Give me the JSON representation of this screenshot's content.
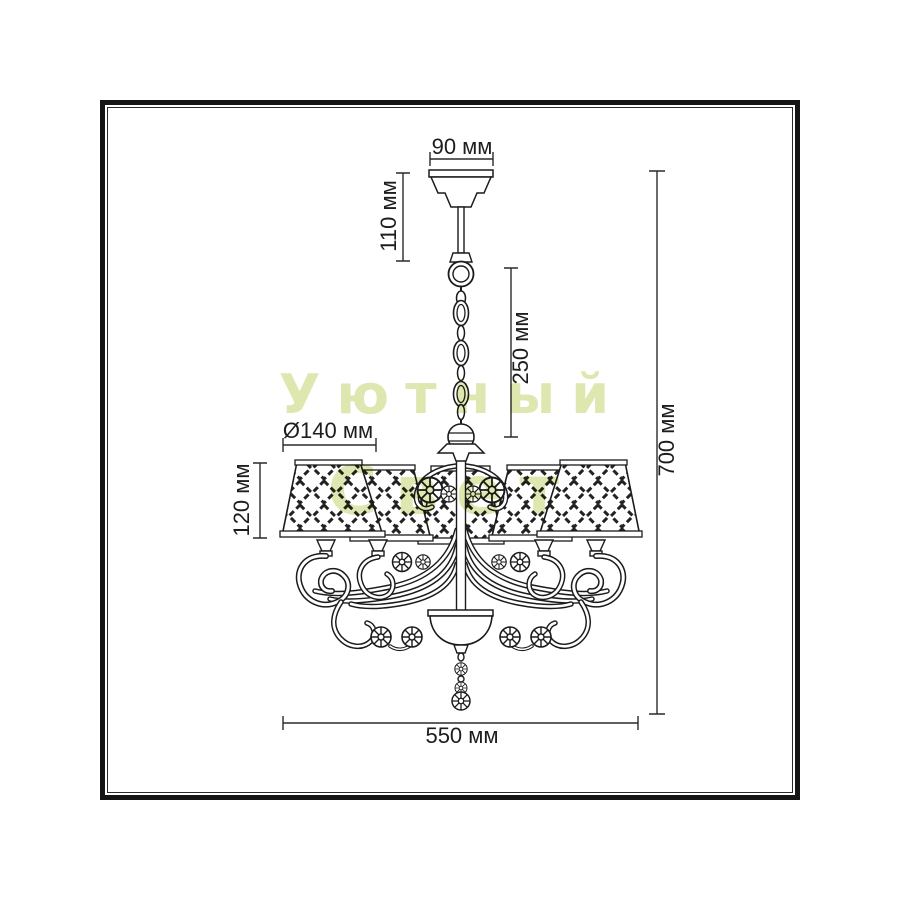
{
  "drawing": {
    "subject": "Chandelier dimensional technical drawing",
    "lampshade_count": 5,
    "line_color": "#1b1b1b",
    "background": "#ffffff",
    "frame_color": "#151515"
  },
  "dims": {
    "canopy_width": "90 мм",
    "top_drop": "110 мм",
    "chain_drop": "250 мм",
    "total_height": "700 мм",
    "shade_diameter": "Ø140 мм",
    "shade_height": "120 мм",
    "total_width": "550 мм"
  },
  "watermark": {
    "line1": "Уютный",
    "line2": "Свет",
    "color": "#dde7af"
  }
}
